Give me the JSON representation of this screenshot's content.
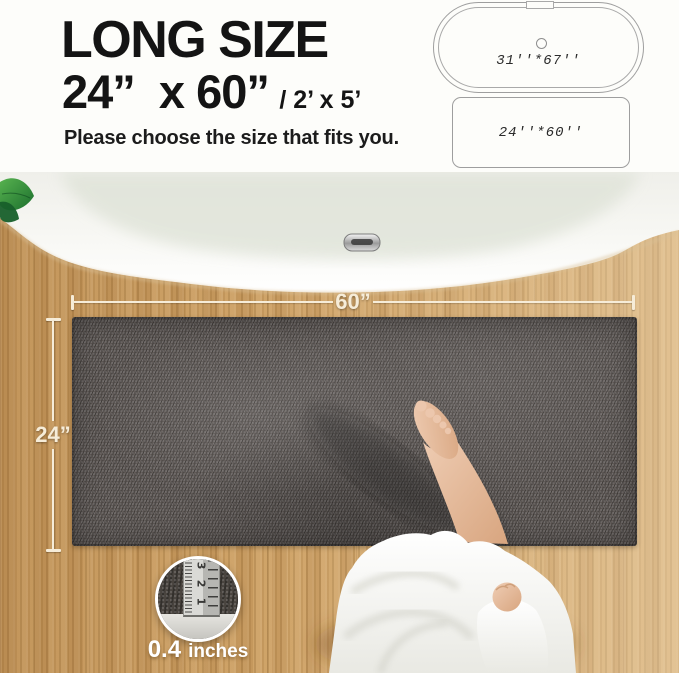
{
  "header": {
    "title": "LONG SIZE",
    "size_main": "24”  x 60”",
    "size_alt": "/ 2’ x 5’",
    "subtitle": "Please choose the size that fits you."
  },
  "size_diagrams": {
    "bathtub_label": "31''*67''",
    "mat_label": "24''*60''"
  },
  "photo_overlay": {
    "width_label": "60”",
    "height_label": "24”",
    "thickness_value": "0.4",
    "thickness_unit": "inches",
    "ruler_numbers": [
      "3",
      "2",
      "1"
    ]
  },
  "colors": {
    "page_bg": "#fdfdfa",
    "heading_text": "#141414",
    "diagram_outline": "#9e9e9e",
    "diagram_text": "#2b2b2b",
    "wood_base": "#c99a5c",
    "mat_base": "#57514e",
    "dimension_line": "#f6ecd8",
    "tub_white": "#fafaf7",
    "leaf_green": "#2f8b3b",
    "skin": "#e9c3a8",
    "robe_white": "#f8f8f4"
  }
}
